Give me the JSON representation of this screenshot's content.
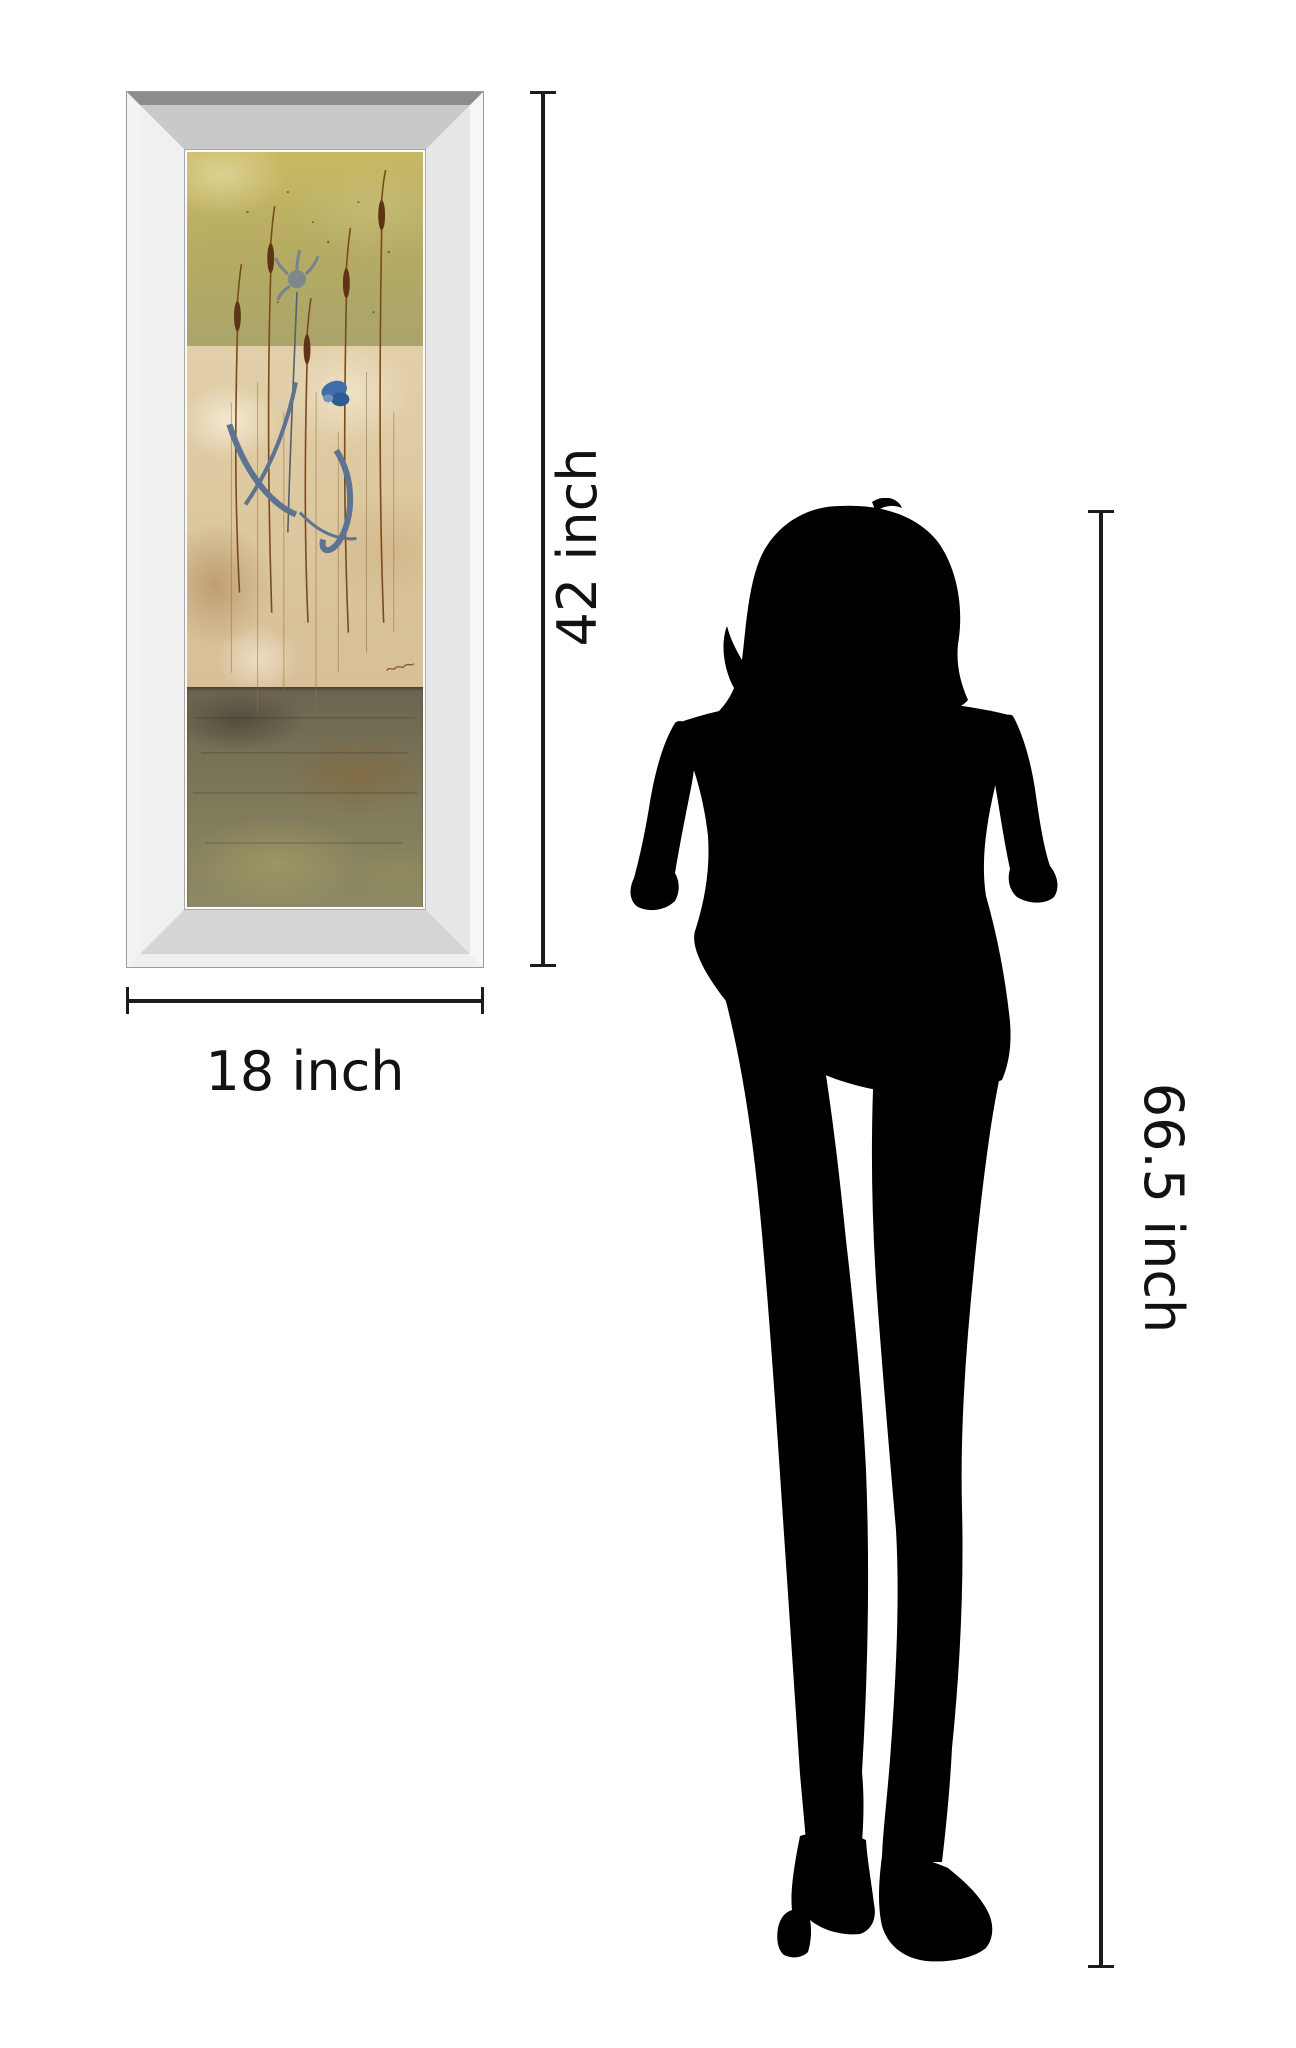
{
  "canvas": {
    "width_px": 1296,
    "height_px": 2048,
    "background": "#ffffff"
  },
  "annotations": {
    "art_height_label": "42 inch",
    "art_width_label": "18 inch",
    "person_height_label": "66.5 inch",
    "line_color": "#1c1c1c",
    "text_color": "#121212"
  },
  "framed_art": {
    "frame": {
      "type": "mirror-bevel-frame",
      "outer_edge_top": "#8c8c8c",
      "outer_edge_sides": "#f6f6f6",
      "bevel_top": "#c9c9c9",
      "bevel_left": "#f0f0f0",
      "bevel_right": "#e6e6e6",
      "bevel_bottom": "#d5d5d5"
    },
    "painting": {
      "motif": "abstract-floral-panel-with-cattails-and-blue-iris",
      "bands": [
        {
          "name": "upper-olive-band",
          "colors": [
            "#cabb63",
            "#a9a46c"
          ]
        },
        {
          "name": "middle-beige-band",
          "colors": [
            "#e2cfa9",
            "#d7bf97"
          ]
        },
        {
          "name": "lower-dark-ground-band",
          "colors": [
            "#6a6450",
            "#8e8a64"
          ]
        }
      ],
      "motif_colors": {
        "cattail_head": "#5e3514",
        "stem": "#7b4b1c",
        "blue_flower": "#3f6fa6",
        "gray_blue_flower": "#75858f",
        "leaves": "#5d7391",
        "signature_ink": "#8a5526"
      }
    }
  },
  "silhouette": {
    "figure": "standing-woman",
    "color": "#000000"
  }
}
